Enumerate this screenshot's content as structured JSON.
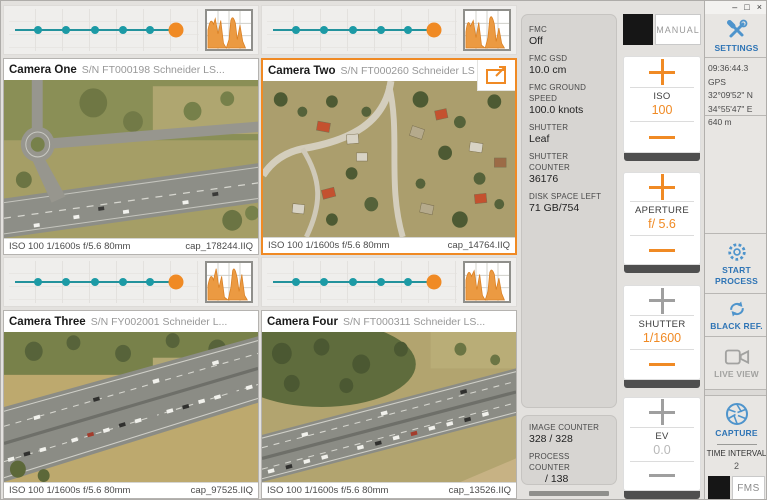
{
  "colors": {
    "accent_orange": "#F08A24",
    "teal": "#1C9AA5",
    "label_blue": "#2E74B5",
    "icon_blue": "#4E94CC"
  },
  "window": {
    "minimize": "–",
    "maximize": "□",
    "close": "×"
  },
  "icons": {
    "settings-icon": "crossed wrench and screwdriver",
    "start-process-icon": "gear",
    "black-ref-icon": "refresh arrows",
    "live-view-icon": "video camera",
    "capture-icon": "aperture blades",
    "expand-icon": "open in new window arrow",
    "histogram-icon": "orange histogram thumbnail"
  },
  "cameras": [
    {
      "name": "Camera One",
      "serial": "S/N FT000198 Schneider LS...",
      "settings": "ISO 100 1/1600s f/5.6 80mm",
      "filename": "cap_178244.IIQ",
      "selected": false
    },
    {
      "name": "Camera Two",
      "serial": "S/N FT000260 Schneider LS",
      "settings": "ISO 100 1/1600s f/5.6 80mm",
      "filename": "cap_14764.IIQ",
      "selected": true
    },
    {
      "name": "Camera Three",
      "serial": "S/N FY002001 Schneider L...",
      "settings": "ISO 100 1/1600s f/5.6 80mm",
      "filename": "cap_97525.IIQ",
      "selected": false
    },
    {
      "name": "Camera Four",
      "serial": "S/N FT000311 Schneider LS...",
      "settings": "ISO 100 1/1600s f/5.6 80mm",
      "filename": "cap_13526.IIQ",
      "selected": false
    }
  ],
  "info_panel": {
    "fields": [
      {
        "label": "FMC",
        "value": "Off"
      },
      {
        "label": "FMC GSD",
        "value": "10.0 cm"
      },
      {
        "label": "FMC GROUND SPEED",
        "value": "100.0 knots"
      },
      {
        "label": "SHUTTER",
        "value": "Leaf"
      },
      {
        "label": "SHUTTER COUNTER",
        "value": "36176"
      },
      {
        "label": "DISK SPACE LEFT",
        "value": "71 GB/754"
      }
    ]
  },
  "counters": {
    "image_label": "IMAGE COUNTER",
    "image_value": "328 / 328",
    "process_label": "PROCESS COUNTER",
    "process_value": "/ 138"
  },
  "exposure": {
    "manual_label": "MANUAL",
    "iso": {
      "label": "ISO",
      "value": "100"
    },
    "aperture": {
      "label": "APERTURE",
      "value": "f/ 5.6"
    },
    "shutter": {
      "label": "SHUTTER",
      "value": "1/1600"
    },
    "ev": {
      "label": "EV",
      "value": "0.0"
    }
  },
  "side": {
    "settings_label": "SETTINGS",
    "gps_time": "09:36:44.3 GPS",
    "gps_lat": "32°09'52\" N",
    "gps_lon": "34°55'47\" E",
    "gps_alt": "640 m",
    "start_process": "START PROCESS",
    "black_ref": "BLACK REF.",
    "live_view": "LIVE VIEW",
    "capture": "CAPTURE",
    "time_interval_label": "TIME INTERVAL",
    "time_interval_value": "2",
    "fms_label": "FMS"
  }
}
